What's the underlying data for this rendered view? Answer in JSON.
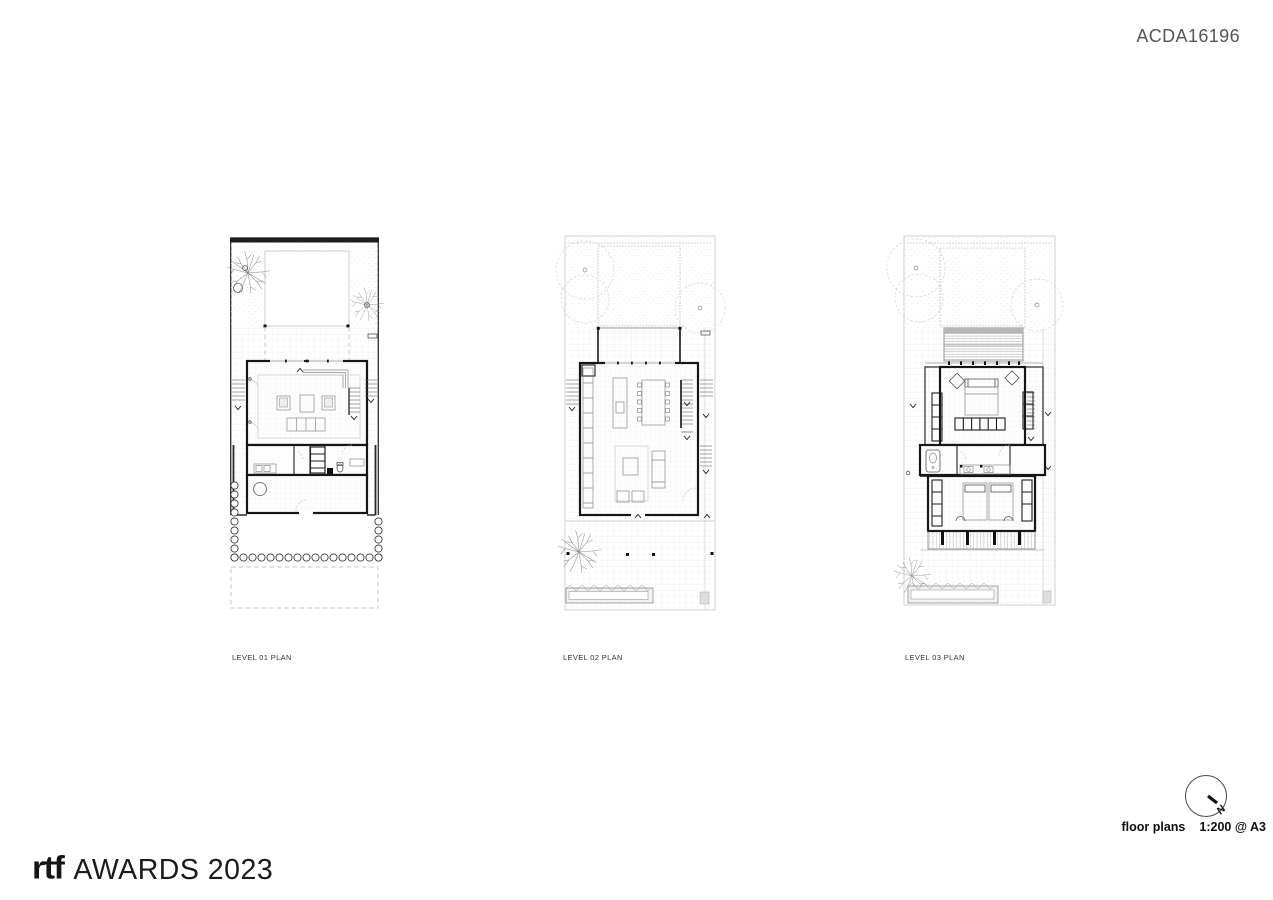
{
  "header": {
    "project_code": "ACDA16196"
  },
  "plans": [
    {
      "label": "LEVEL 01 PLAN"
    },
    {
      "label": "LEVEL 02 PLAN"
    },
    {
      "label": "LEVEL 03 PLAN"
    }
  ],
  "title_block": {
    "title": "floor plans",
    "scale": "1:200 @ A3",
    "north_label": "N"
  },
  "branding": {
    "logo_text": "rtf",
    "award_text": "AWARDS 2023"
  },
  "colors": {
    "ink": "#161616",
    "light_line": "#cccccc",
    "code_gray": "#55565a",
    "paper": "#ffffff"
  }
}
